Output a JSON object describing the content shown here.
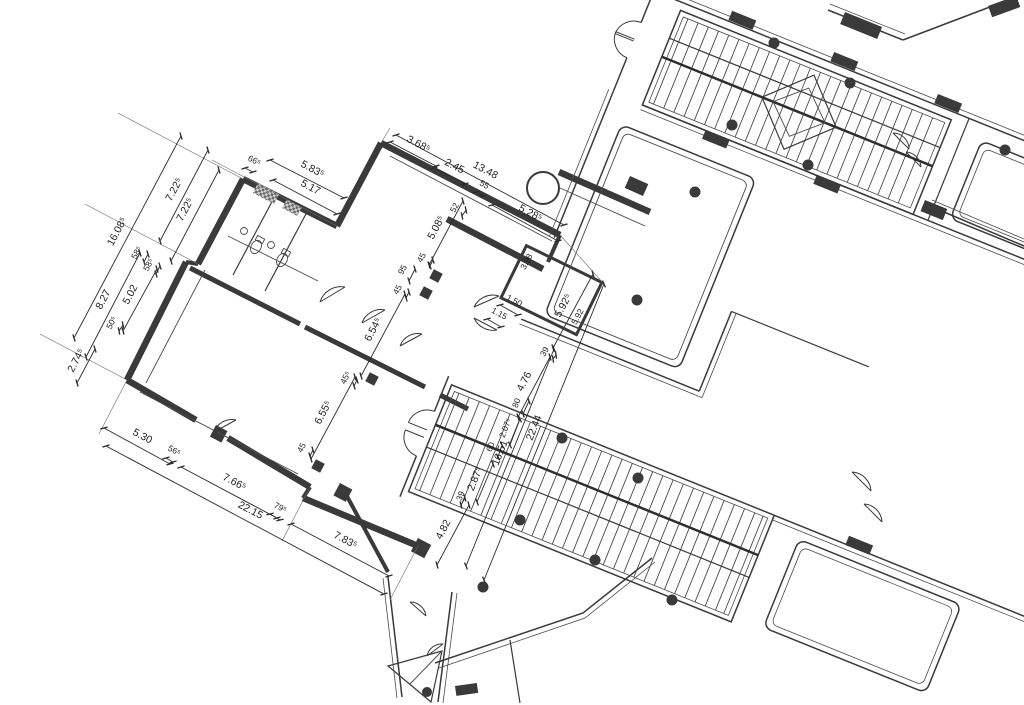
{
  "drawing": {
    "background": "#ffffff",
    "line_color": "#3a3a3a",
    "text_color": "#1f1f1f"
  },
  "dimensions": {
    "wing_top": [
      "66⁵",
      "5.83⁵",
      "5.17"
    ],
    "left_stack": [
      "7.22⁵",
      "7.22⁵",
      "16.08⁵",
      "58⁵",
      "58⁵",
      "8.27",
      "5.02",
      "50⁵",
      "2.74⁵"
    ],
    "upper_wall": [
      "3.68⁵",
      "2.45",
      "13.48",
      "55",
      "5.28⁵"
    ],
    "wall_depth": [
      "52",
      "5.08⁵"
    ],
    "hall_axis": [
      "45",
      "95",
      "45",
      "6.54⁵",
      "45⁵",
      "6.55⁵",
      "45"
    ],
    "bottom_chain": [
      "5.30",
      "56⁵",
      "7.66⁵",
      "22.15",
      "79⁵",
      "7.83⁵"
    ],
    "right_side": [
      "1.15",
      "1.50",
      "3.98",
      "5.92⁵",
      "5.92",
      "39",
      "4.76"
    ],
    "stair_chain": [
      "80",
      "2.07⁵",
      "60",
      "16.51",
      "22.44",
      "2.87⁵",
      "39",
      "4.82"
    ]
  }
}
